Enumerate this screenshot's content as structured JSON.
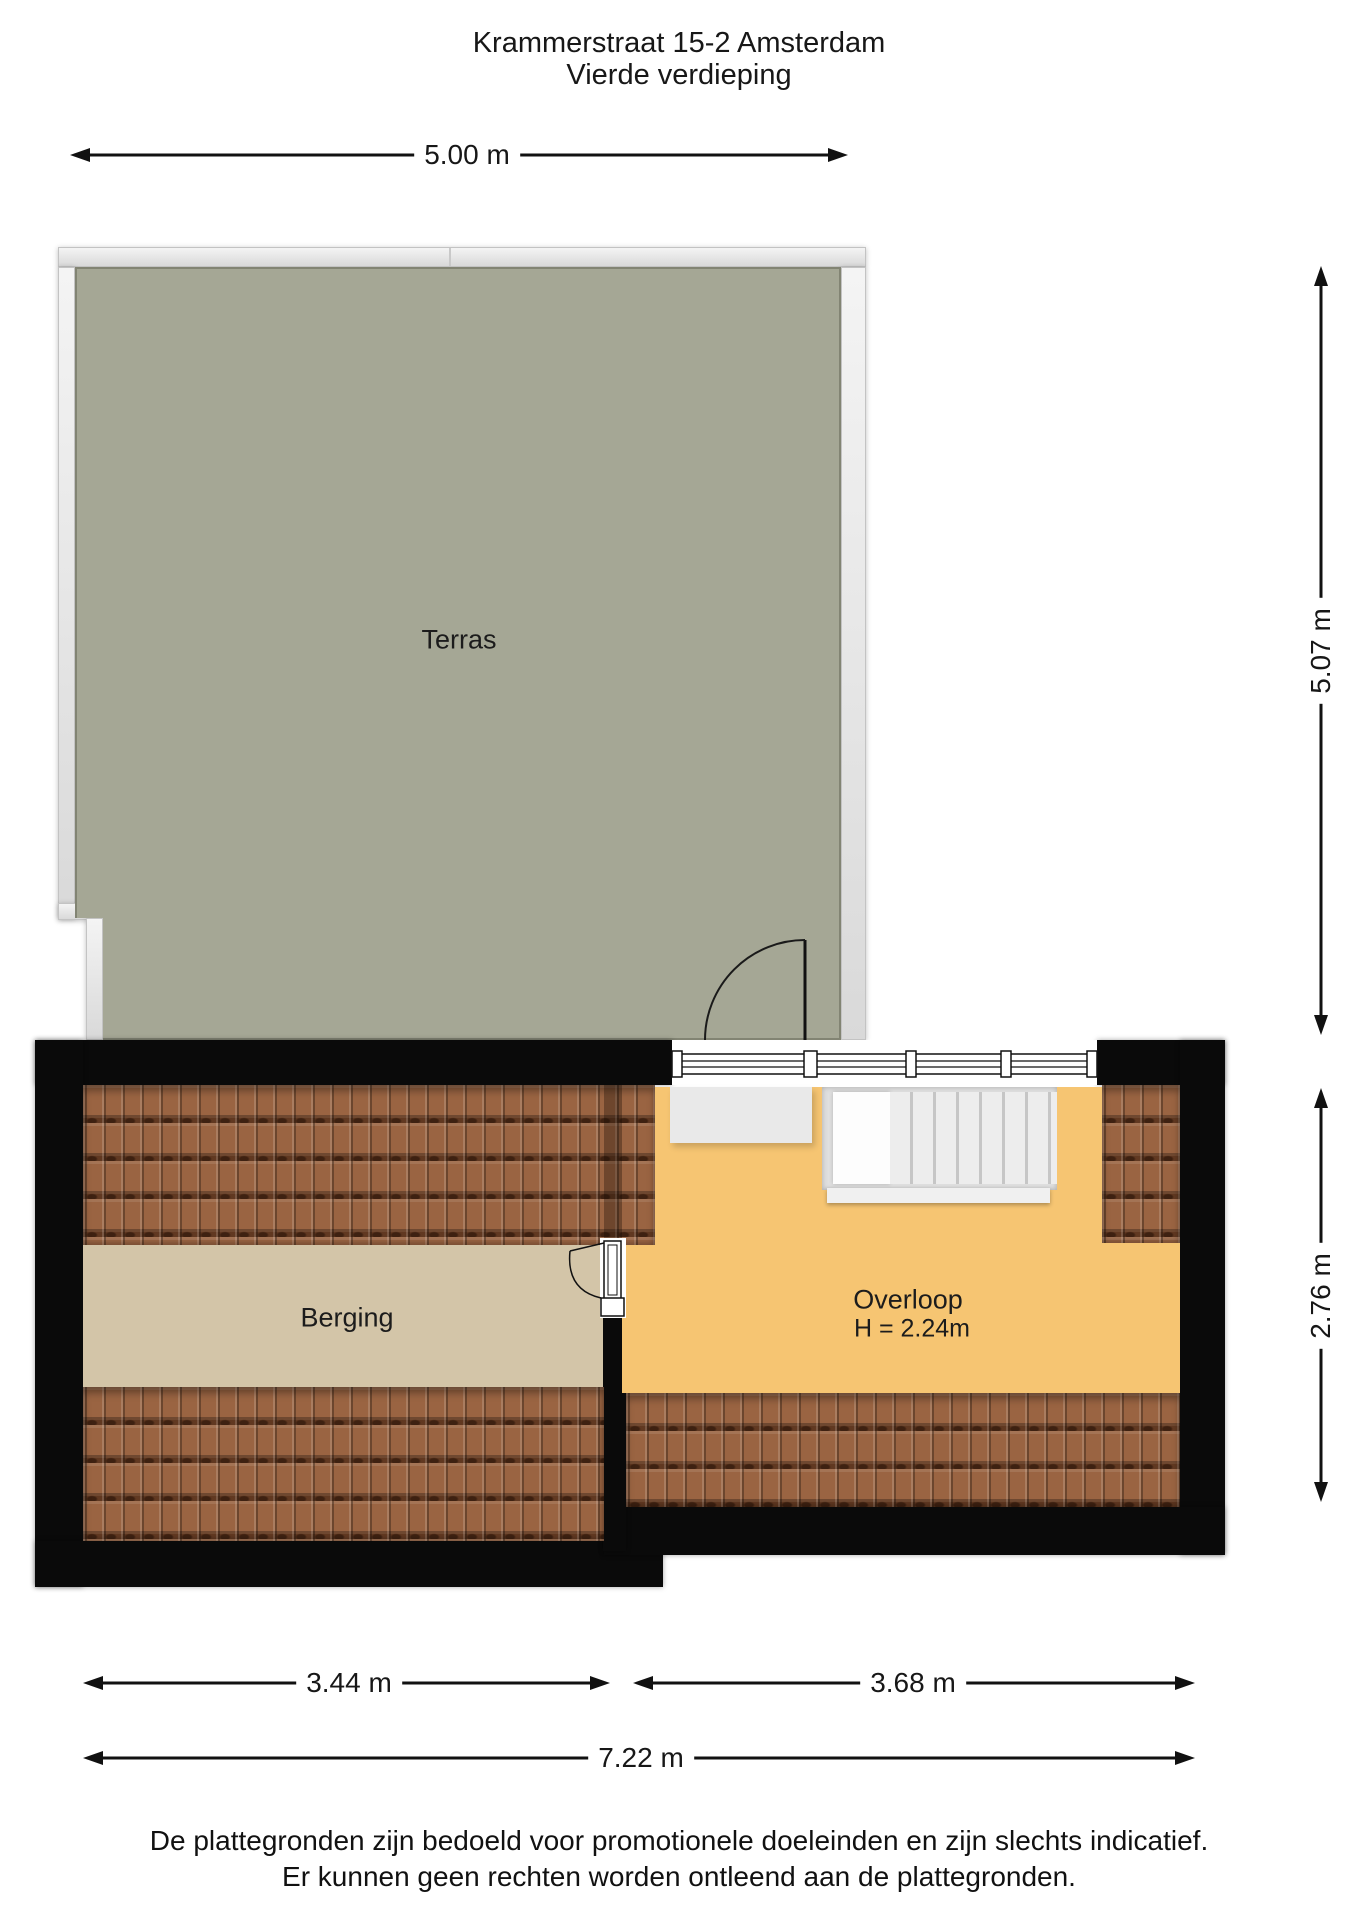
{
  "page": {
    "title_line1": "Krammerstraat 15-2 Amsterdam",
    "title_line2": "Vierde verdieping",
    "footer_line1": "De plattegronden zijn bedoeld voor promotionele doeleinden en zijn slechts indicatief.",
    "footer_line2": "Er kunnen geen rechten worden ontleend aan de plattegronden."
  },
  "floorplan": {
    "floor_name": "Vierde verdieping",
    "rooms": [
      {
        "name": "Terras"
      },
      {
        "name": "Berging"
      },
      {
        "name": "Overloop",
        "ceiling_height": "H = 2.24m"
      }
    ],
    "dimensions": {
      "terrace_width": "5.00 m",
      "terrace_depth": "5.07 m",
      "attic_depth": "2.76 m",
      "berging_width": "3.44 m",
      "overloop_width": "3.68 m",
      "total_width": "7.22 m"
    },
    "colors": {
      "terrace_floor": "#a5a795",
      "overloop_floor": "#f6c572",
      "berging_floor": "#d3c5a8",
      "roof_tiles": "#9a6442",
      "walls": "#0a0a0a",
      "railing": "#e9e9e9"
    }
  }
}
